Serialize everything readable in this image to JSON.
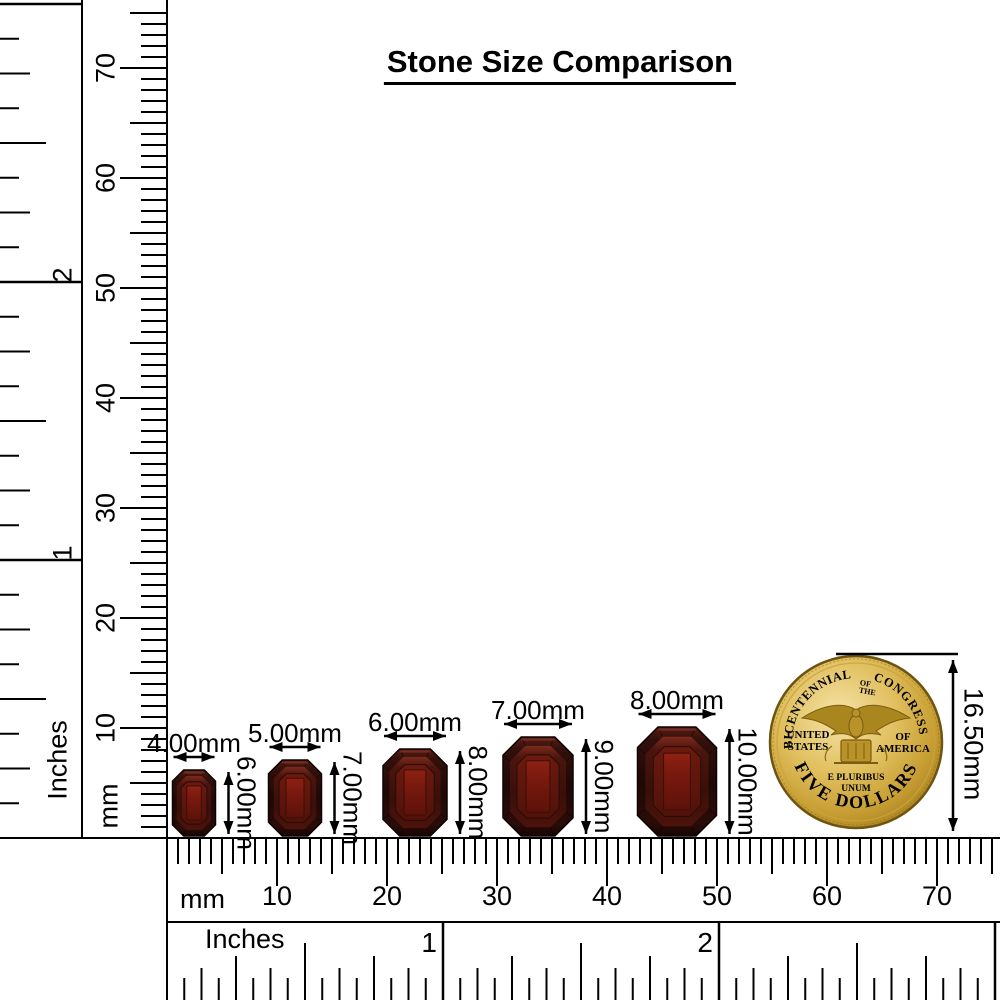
{
  "title": "Stone Size Comparison",
  "left_ruler": {
    "unit_label_mm": "mm",
    "unit_label_inches": "Inches",
    "mm_numbers": [
      10,
      20,
      30,
      40,
      50,
      60,
      70
    ],
    "inch_numbers": [
      1,
      2
    ]
  },
  "bottom_ruler": {
    "unit_label_mm": "mm",
    "unit_label_inches": "Inches",
    "mm_numbers": [
      10,
      20,
      30,
      40,
      50,
      60,
      70
    ],
    "inch_numbers": [
      1,
      2
    ]
  },
  "stones": [
    {
      "width_label": "4.00mm",
      "height_label": "6.00mm",
      "width_mm": 4,
      "height_mm": 6
    },
    {
      "width_label": "5.00mm",
      "height_label": "7.00mm",
      "width_mm": 5,
      "height_mm": 7
    },
    {
      "width_label": "6.00mm",
      "height_label": "8.00mm",
      "width_mm": 6,
      "height_mm": 8
    },
    {
      "width_label": "7.00mm",
      "height_label": "9.00mm",
      "width_mm": 7,
      "height_mm": 9
    },
    {
      "width_label": "8.00mm",
      "height_label": "10.00mm",
      "width_mm": 8,
      "height_mm": 10
    }
  ],
  "coin": {
    "arc_top_left": "BICENTENNIAL",
    "arc_top_center_line1": "OF",
    "arc_top_center_line2": "THE",
    "arc_top_right": "CONGRESS",
    "left_line1": "UNITED",
    "left_line2": "STATES",
    "right_line1": "OF",
    "right_line2": "AMERICA",
    "motto_line1": "E PLURIBUS",
    "motto_line2": "UNUM",
    "arc_bottom": "FIVE DOLLARS",
    "measure_label": "16.50mm"
  },
  "colors": {
    "line": "#000000",
    "background": "#ffffff",
    "stone_edge_dark": "#1f0806",
    "stone_mid": "#3a0f09",
    "stone_table": "#7a190e",
    "stone_table_bright": "#8e2114",
    "stone_highlight": "#7d342a",
    "coin_gold": "#d8b54a",
    "coin_gold_light": "#f6e3a8",
    "coin_gold_dark": "#8a6713",
    "coin_rim": "#6e5410"
  }
}
